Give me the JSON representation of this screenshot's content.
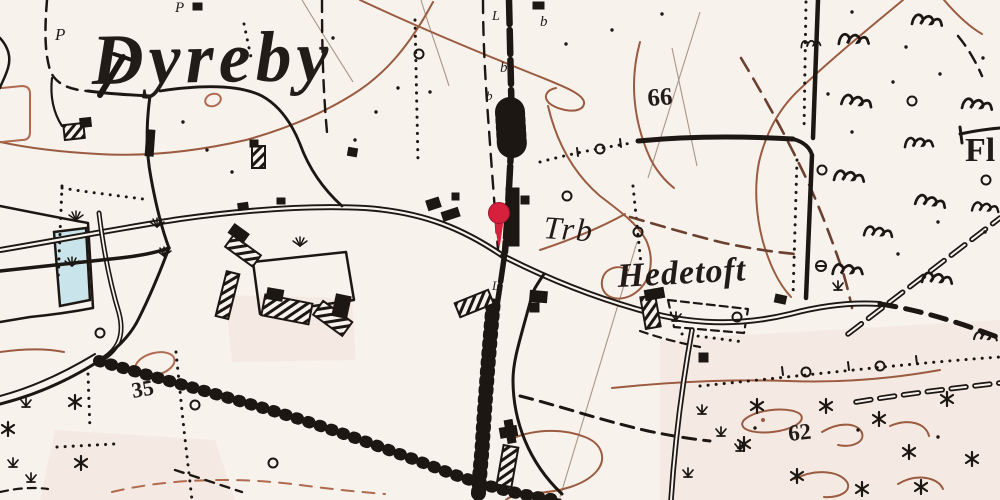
{
  "map": {
    "title_label": {
      "text": "Dyreby"
    },
    "labels": {
      "station": "Trb",
      "farm": "Hedetoft",
      "edge_clipped": "Fl"
    },
    "elevations": {
      "north": "66",
      "west": "35",
      "southeast": "62"
    },
    "post_letters": [
      "P",
      "P",
      "L",
      "b",
      "b",
      "b",
      "L"
    ],
    "marker": {
      "type": "location-pin",
      "color": "#d6203c"
    },
    "colors": {
      "paper": "#f7f2ec",
      "ink": "#1c1713",
      "contour_brown": "#9b5b40",
      "contour_light": "#b06a50",
      "dashed_road_sepia": "#6b4030",
      "pond_blue": "#c9e4ea",
      "heath_tint_pink": "#f3e2da",
      "label_text": "#221c18",
      "marker_red": "#d6203c"
    }
  }
}
